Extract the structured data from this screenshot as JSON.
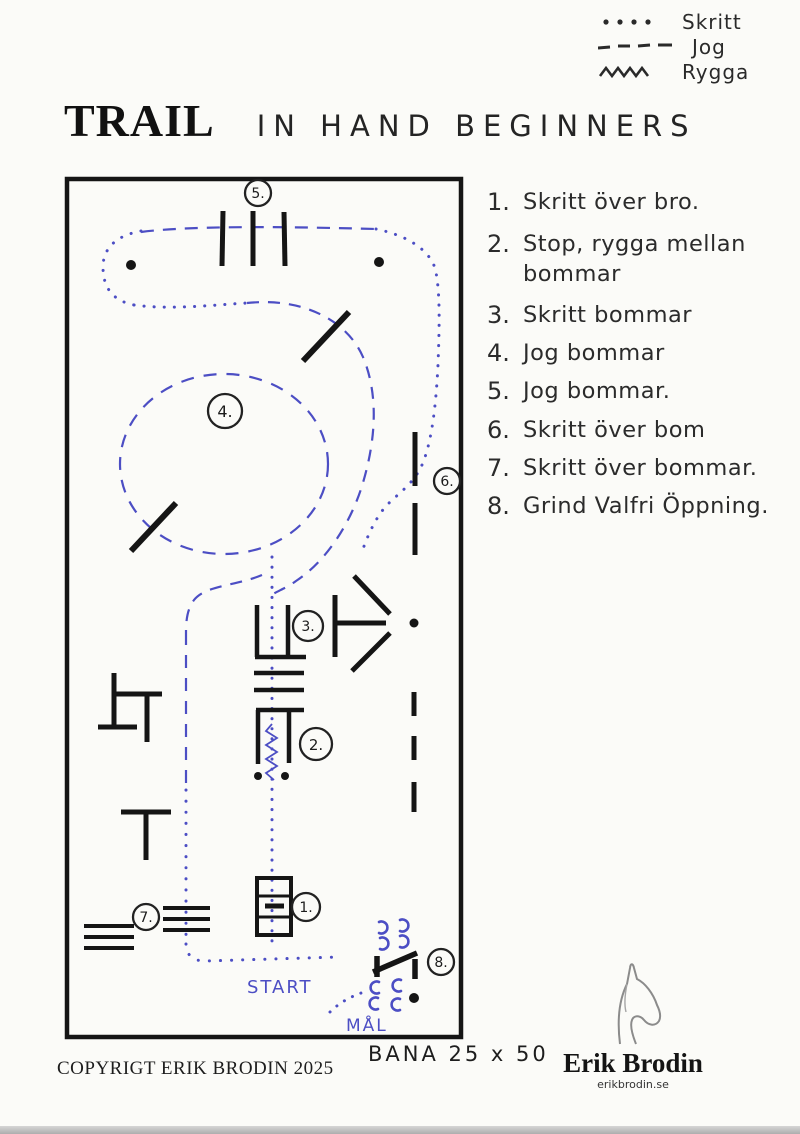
{
  "legend": {
    "items": [
      {
        "icon": "dotted-line-icon",
        "label": "Skritt"
      },
      {
        "icon": "dashed-line-icon",
        "label": "Jog"
      },
      {
        "icon": "zigzag-line-icon",
        "label": "Rygga"
      }
    ]
  },
  "title": {
    "printed": "TRAIL",
    "handwritten": "IN HAND BEGINNERS"
  },
  "instructions": [
    {
      "number": "1.",
      "text": "Skritt över bro."
    },
    {
      "number": "2.",
      "text": "Stop, rygga mellan bommar"
    },
    {
      "number": "3.",
      "text": "Skritt bommar"
    },
    {
      "number": "4.",
      "text": "Jog bommar"
    },
    {
      "number": "5.",
      "text": "Jog bommar."
    },
    {
      "number": "6.",
      "text": "Skritt över bom"
    },
    {
      "number": "7.",
      "text": "Skritt över bommar."
    },
    {
      "number": "8.",
      "text": "Grind Valfri Öppning."
    }
  ],
  "course_map": {
    "start_label": "START",
    "goal_label": "MÅL",
    "obstacles": [
      {
        "id": "1.",
        "name": "bridge"
      },
      {
        "id": "2.",
        "name": "stop-back-between-poles"
      },
      {
        "id": "3.",
        "name": "walk-poles"
      },
      {
        "id": "4.",
        "name": "jog-circle"
      },
      {
        "id": "5.",
        "name": "jog-poles"
      },
      {
        "id": "6.",
        "name": "walk-over-pole"
      },
      {
        "id": "7.",
        "name": "walk-over-poles"
      },
      {
        "id": "8.",
        "name": "gate-optional-opening"
      }
    ],
    "colors": {
      "ink": "#1c1c1c",
      "pen_blue": "#4c4ec4"
    }
  },
  "footer": {
    "copyright": "COPYRIGT ERIK BRODIN 2025",
    "arena_size": "BANA 25 x 50"
  },
  "logo": {
    "name": "Erik Brodin",
    "website": "erikbrodin.se",
    "icon": "horse-head-icon"
  }
}
